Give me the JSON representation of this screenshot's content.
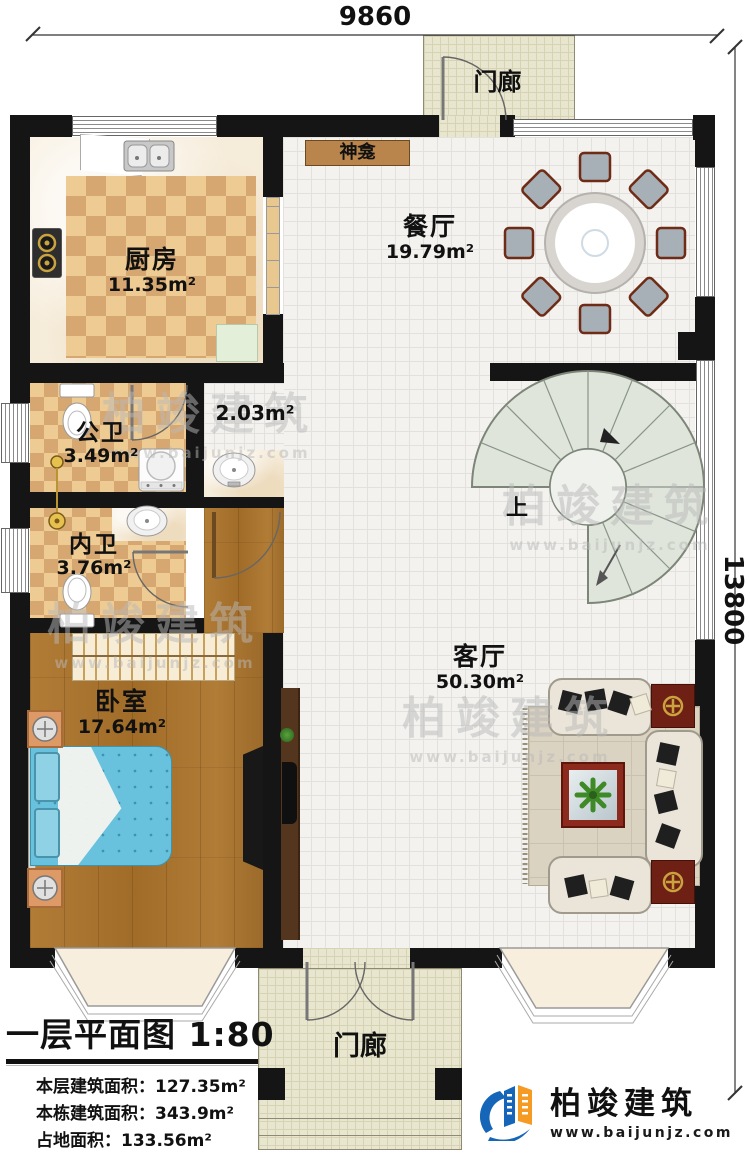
{
  "dimensions": {
    "top": "9860",
    "right": "13800"
  },
  "rooms": {
    "porch_top": {
      "name": "门廊"
    },
    "porch_bottom": {
      "name": "门廊"
    },
    "kitchen": {
      "name": "厨房",
      "area": "11.35m²"
    },
    "shrine": {
      "name": "神龛"
    },
    "dining": {
      "name": "餐厅",
      "area": "19.79m²"
    },
    "hall": {
      "area": "2.03m²"
    },
    "public_bath": {
      "name": "公卫",
      "area": "3.49m²"
    },
    "inner_bath": {
      "name": "内卫",
      "area": "3.76m²"
    },
    "bedroom": {
      "name": "卧室",
      "area": "17.64m²"
    },
    "living": {
      "name": "客厅",
      "area": "50.30m²"
    },
    "stairs": {
      "direction": "上"
    }
  },
  "title_block": {
    "title": "一层平面图 1:80",
    "lines": [
      "本层建筑面积：127.35m²",
      "本栋建筑面积：343.9m²",
      "占地面积：133.56m²",
      "层高：3.8m"
    ]
  },
  "logo": {
    "name": "柏竣建筑",
    "url": "www.baijunjz.com"
  },
  "watermark": {
    "text": "柏竣建筑",
    "sub": "www.baijunjz.com"
  },
  "colors": {
    "wall": "#151515",
    "accent_wood": "#a9742f",
    "logo_blue": "#1565b8",
    "logo_orange": "#f59a23"
  }
}
